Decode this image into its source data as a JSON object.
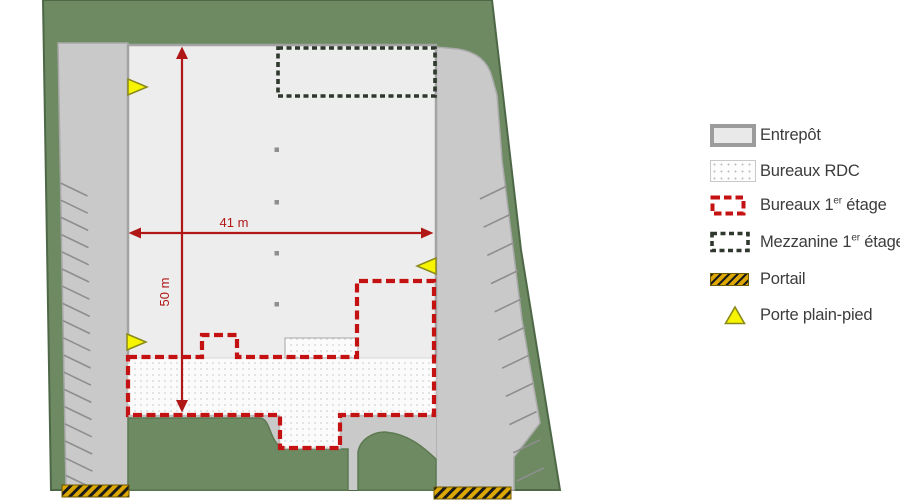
{
  "plan": {
    "dimensions": {
      "width_label": "41 m",
      "height_label": "50 m"
    }
  },
  "legend": {
    "items": [
      {
        "id": "entrepot",
        "label": "Entrepôt"
      },
      {
        "id": "bureaux-rdc",
        "label": "Bureaux RDC"
      },
      {
        "id": "bureaux-1er",
        "label_pre": "Bureaux 1",
        "label_sup": "er",
        "label_post": " étage"
      },
      {
        "id": "mezzanine-1er",
        "label_pre": "Mezzanine 1",
        "label_sup": "er",
        "label_post": " étage"
      },
      {
        "id": "portail",
        "label": "Portail"
      },
      {
        "id": "porte-plain-pied",
        "label": "Porte plain-pied"
      }
    ]
  },
  "colors": {
    "site_green": "#6d8a62",
    "site_green_edge": "#4e6847",
    "pavement_gray": "#c9c9c9",
    "warehouse_fill": "#ededed",
    "warehouse_edge": "#a3a3a3",
    "offices_red": "#c41212",
    "dimension_red": "#b01818",
    "mezzanine_dark": "#2e382c",
    "gate_yellow": "#dca700",
    "door_yellow": "#f7f400"
  }
}
